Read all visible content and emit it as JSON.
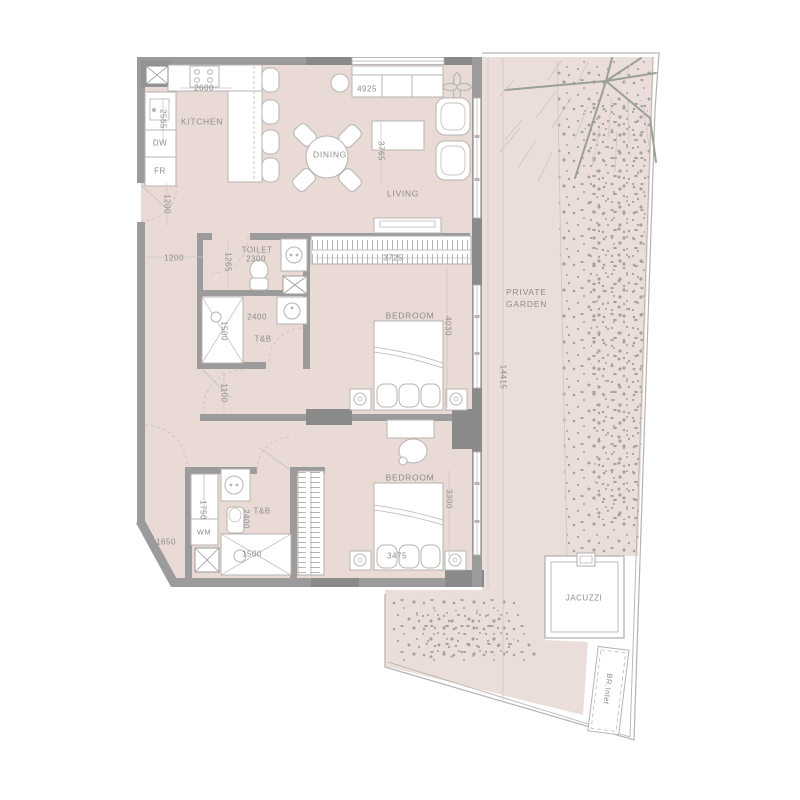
{
  "plan": {
    "title": "apartment-floor-plan",
    "rooms": {
      "kitchen": "KITCHEN",
      "dining": "DINING",
      "living": "LIVING",
      "toilet": "TOILET",
      "toilet_bath_1": "T&B",
      "bedroom_1": "BEDROOM",
      "toilet_bath_2": "T&B",
      "bedroom_2": "BEDROOM",
      "private_garden": "PRIVATE GARDEN",
      "jacuzzi": "JACUZZI",
      "br_inlet": "BR.Inlet"
    },
    "appliances": {
      "dishwasher": "DW",
      "fridge": "FR",
      "washing_machine": "WM"
    },
    "dimensions_mm": {
      "kitchen_counter": "2600",
      "kitchen_depth": "2565",
      "entry_hall": "1200",
      "hall_width": "1200",
      "toilet_width": "2300",
      "toilet_depth": "1265",
      "living_sofa_wall": "4925",
      "living_depth": "3765",
      "wardrobe_1": "3725",
      "bedroom_1_depth": "4030",
      "tb1_width": "2400",
      "shower_1": "1500",
      "corridor": "1100",
      "garden_length": "14415",
      "tb2_depth": "1750",
      "tb2_width": "1650",
      "tb2_inner": "2400",
      "shower_2": "1500",
      "bedroom_2_width": "3475",
      "bedroom_2_depth": "3300"
    },
    "colors": {
      "background": "#ffffff",
      "floor": "#e9dad6",
      "garden": "#ebdeda",
      "wall": "#9b9b9b",
      "wall_dark": "#8a8a8a",
      "outline": "#b6b2ae",
      "text": "#8e8b88",
      "speckle": "#a6a29b",
      "tree": "#9aa096"
    }
  }
}
